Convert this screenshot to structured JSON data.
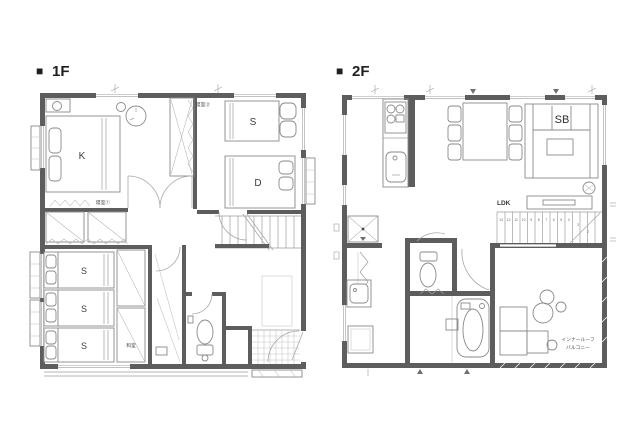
{
  "canvas": {
    "width": 640,
    "height": 427,
    "background": "#ffffff"
  },
  "palette": {
    "wall": "#5d5d5d",
    "furniture_line": "#8a8a8a",
    "thin_line": "#9e9e9e",
    "grid_line": "#bcbcbc",
    "title_text": "#1f1f1f",
    "label_text": "#4a4a4a"
  },
  "floor1": {
    "marker": "■",
    "title": "1F",
    "labels": {
      "bedroom1": "寝室①",
      "bedroom2": "寝室②",
      "tatami": "和室",
      "bed_k": "K",
      "bed_s": "S",
      "bed_d": "D",
      "tatami_beds": [
        "S",
        "S",
        "S"
      ]
    }
  },
  "floor2": {
    "marker": "■",
    "title": "2F",
    "labels": {
      "ldk": "LDK",
      "sofa": "SB",
      "balcony_line1": "インナールーフ",
      "balcony_line2": "バルコニー",
      "stair_numbers": [
        "13",
        "12",
        "11",
        "10",
        "9",
        "8",
        "7",
        "6",
        "5",
        "4",
        "3",
        "2"
      ]
    }
  }
}
